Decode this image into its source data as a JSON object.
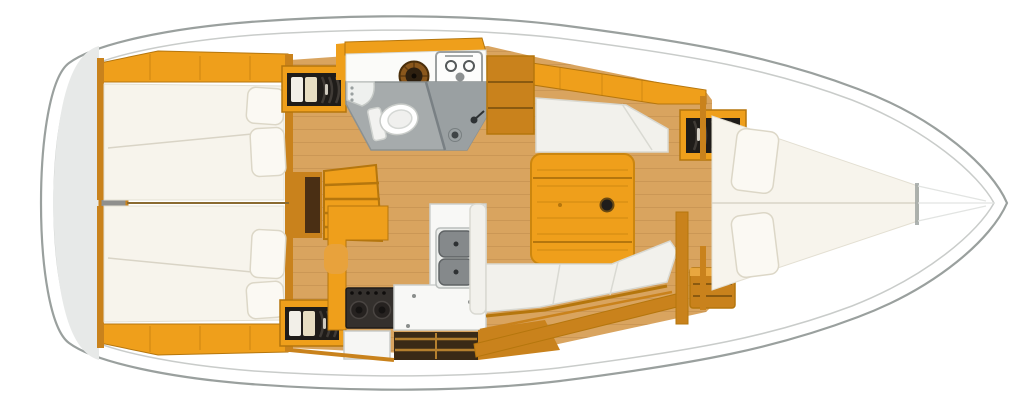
{
  "meta": {
    "type": "boat-interior-floor-plan",
    "view": "top-down",
    "bow_direction": "right",
    "stern_direction": "left"
  },
  "colors": {
    "hullLine": "#9aa09e",
    "innerLine": "#c9ccca",
    "sternGray": "#e7e9e8",
    "wood": "#ef9f1b",
    "woodDark": "#c9821c",
    "woodLine": "#b5760d",
    "floor": "#d9a45f",
    "floorLine": "#b98648",
    "mattress": "#f7f4ec",
    "mattressLine": "#d9d4c6",
    "cushion": "#f2f1ec",
    "headFloor": "#a6abac",
    "showerFloor": "#9aa0a2",
    "dark": "#221f1c",
    "counterWhite": "#f8f8f6",
    "steel": "#85898b"
  },
  "compartments": {
    "stern": {
      "label": "Stern transom and engine compartment",
      "fixtures": [
        "engine-hatch"
      ]
    },
    "aft_cabin_top": {
      "label": "Aft double cabin (top)",
      "fixtures": [
        "double-berth",
        "two-pillows",
        "hanging-locker-with-clothes",
        "hull-side-shelf"
      ]
    },
    "aft_cabin_bottom": {
      "label": "Aft double cabin (bottom)",
      "fixtures": [
        "double-berth",
        "two-pillows",
        "hanging-locker-with-clothes",
        "hull-side-shelf"
      ]
    },
    "companionway": {
      "label": "Companionway steps",
      "fixtures": [
        "wood-steps",
        "engine-box-front"
      ]
    },
    "head": {
      "label": "Head with separate shower",
      "fixtures": [
        "marine-toilet",
        "corner-washbasin",
        "round-basin",
        "two-burner-unit",
        "shower-stall",
        "floor-drain",
        "shower-head"
      ]
    },
    "galley": {
      "label": "L-shaped galley",
      "fixtures": [
        "gimballed-stove",
        "oven-front",
        "double-sink",
        "faucet",
        "worktop",
        "storage-lockers"
      ]
    },
    "saloon": {
      "label": "Saloon",
      "fixtures": [
        "folding-dining-table",
        "cup-recess",
        "straight-settee",
        "l-shaped-settee",
        "hanging-locker-with-clothes",
        "drawer-chest",
        "side-cabinet"
      ]
    },
    "forward_cabin": {
      "label": "Forward V-berth cabin",
      "fixtures": [
        "v-berth",
        "two-pillows"
      ]
    },
    "bow": {
      "label": "Bow / anchor locker",
      "fixtures": []
    }
  }
}
